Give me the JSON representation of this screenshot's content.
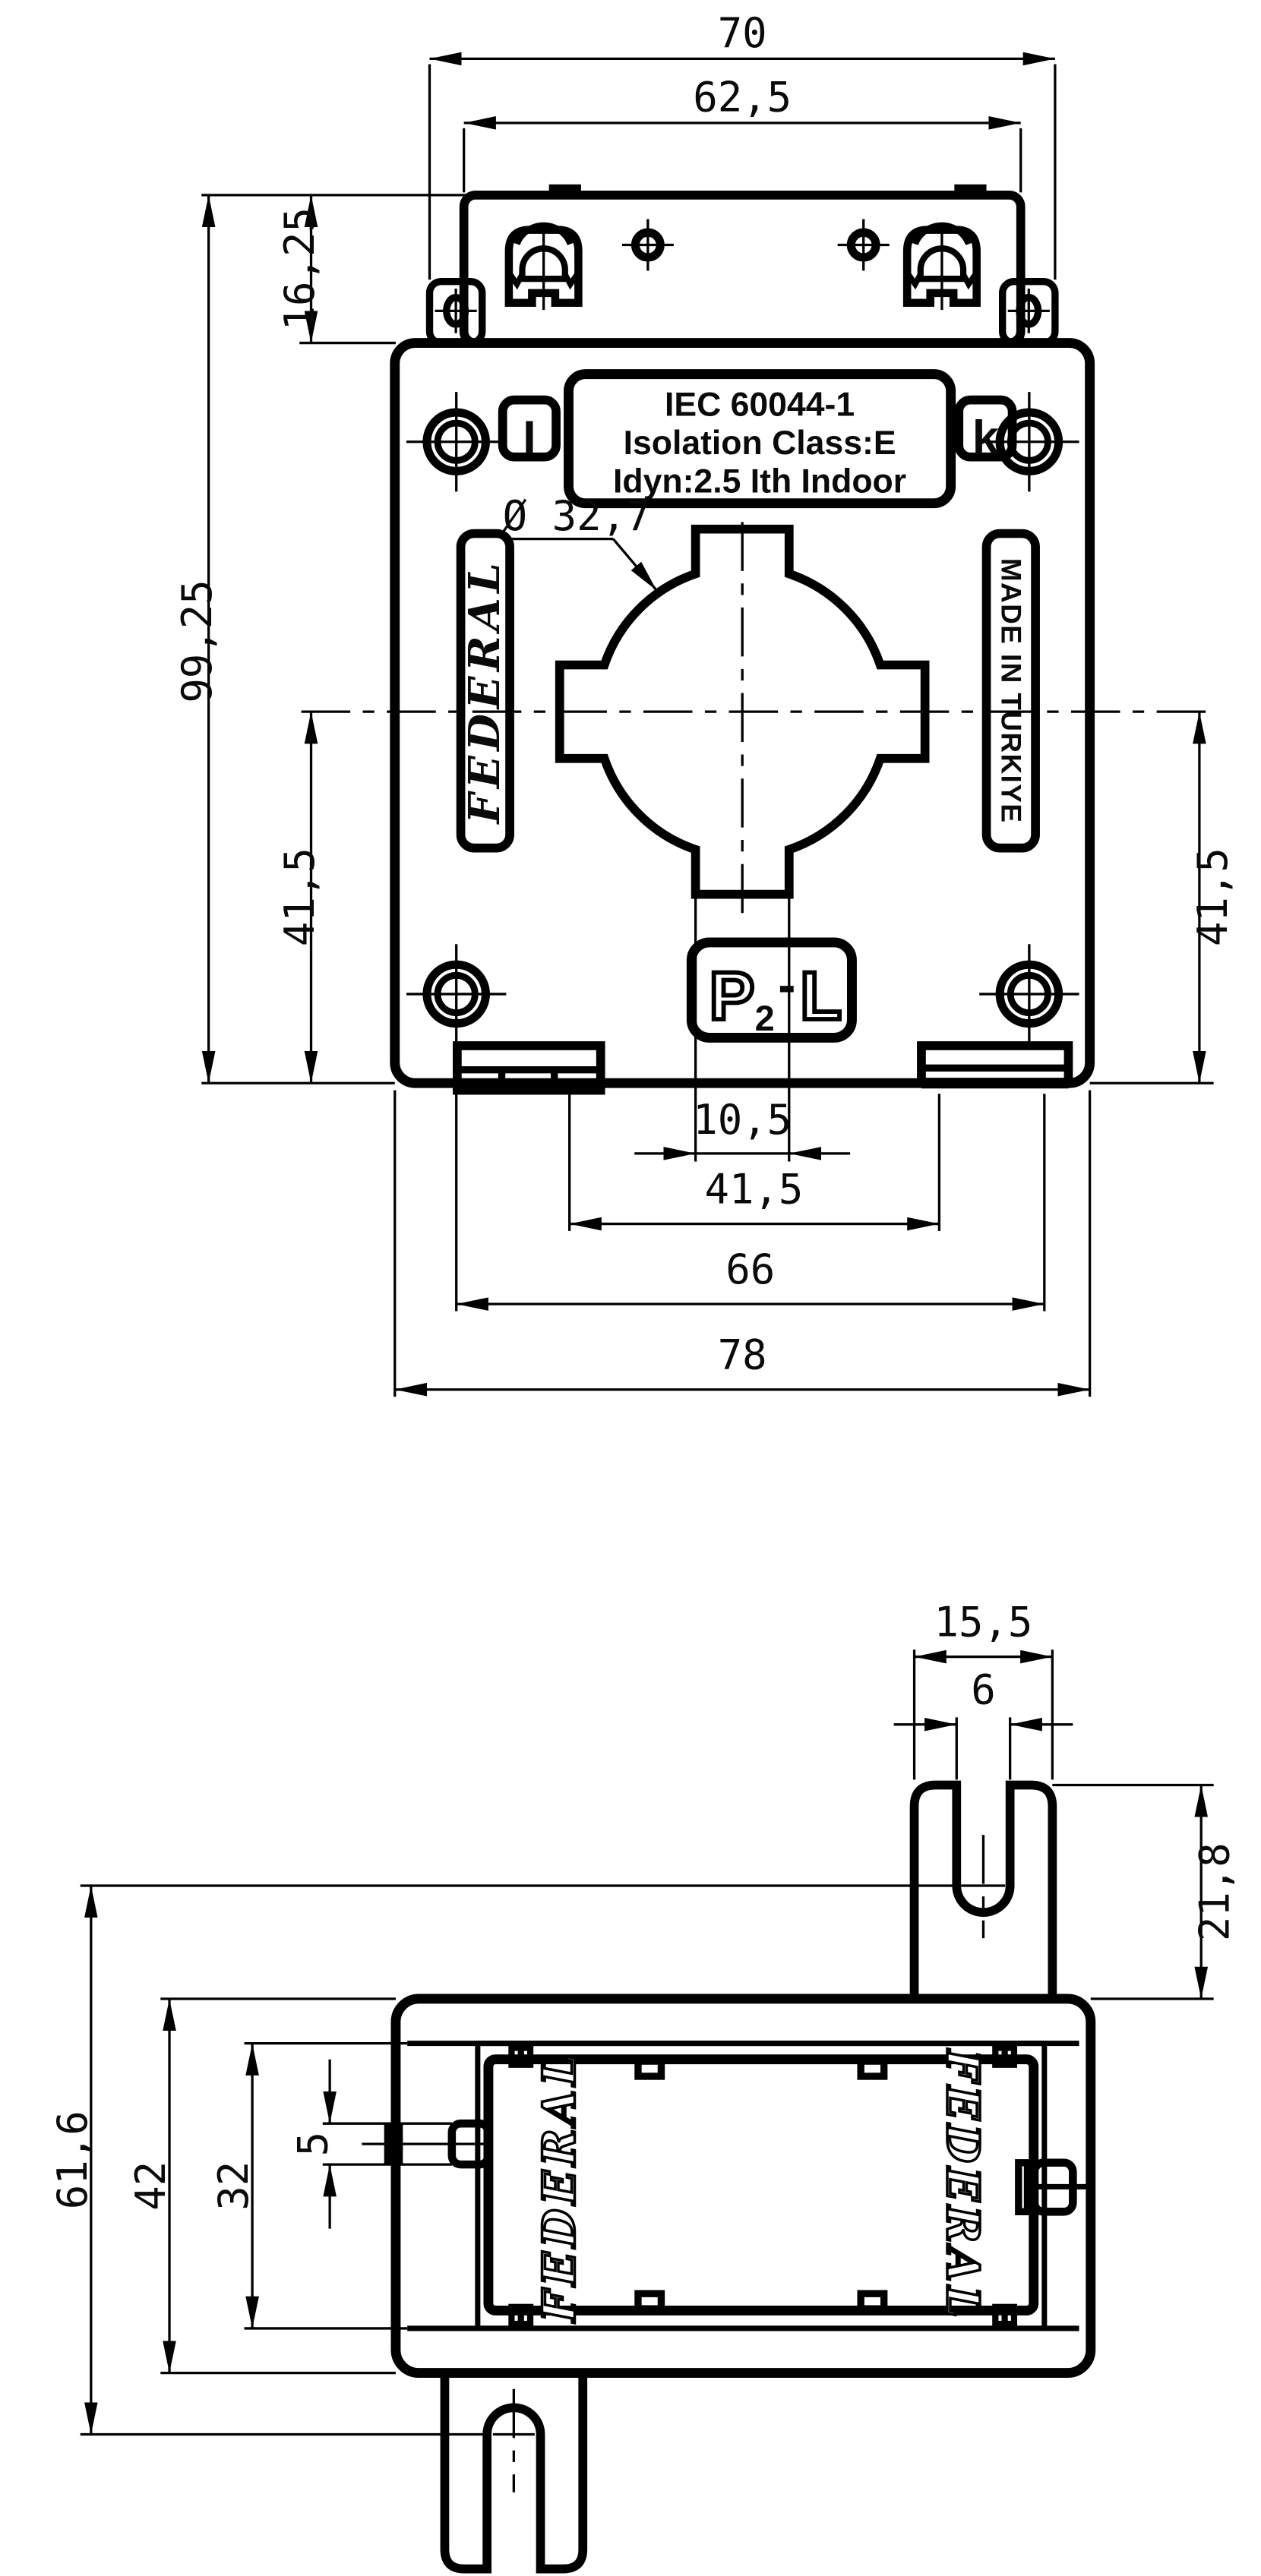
{
  "colors": {
    "line": "#000000",
    "background": "#ffffff"
  },
  "front_view": {
    "dims": {
      "top_width": "70",
      "terminal_width": "62,5",
      "terminal_height": "16,25",
      "overall_height": "99,25",
      "lower_left_height": "41,5",
      "lower_right_height": "41,5",
      "bore_diameter": "Ø 32,7",
      "notch_width": "10,5",
      "feet_span": "41,5",
      "hole_span": "66",
      "overall_width": "78"
    },
    "labels": {
      "cert_line1": "IEC 60044-1",
      "cert_line2": "Isolation Class:E",
      "cert_line3": "Idyn:2.5 Ith Indoor",
      "terminal_l": "I",
      "terminal_k": "k",
      "brand": "FEDERAL",
      "made_in": "MADE IN TURKIYE",
      "polarity_p": "P",
      "polarity_2": "2",
      "polarity_dash": "-",
      "polarity_l": "L"
    }
  },
  "side_view": {
    "dims": {
      "tab_width": "15,5",
      "slot_width": "6",
      "tab_height": "21,8",
      "terminal_span": "61,6",
      "body_height": "42",
      "window_height": "32",
      "latch_height": "5"
    },
    "labels": {
      "brand_left": "FEDERAL",
      "brand_right": "FEDERAL"
    }
  }
}
